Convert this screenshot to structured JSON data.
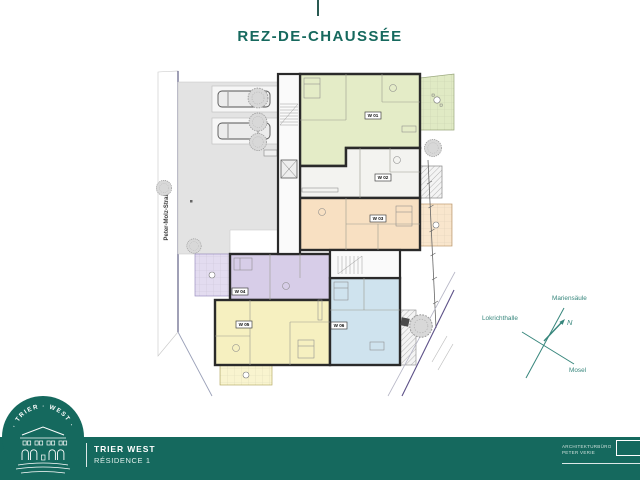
{
  "page": {
    "title": "REZ-DE-CHAUSSÉE"
  },
  "plan": {
    "street_label": "Peter-Molz-Straße",
    "units": [
      {
        "id": "W 01",
        "color": "#e4ecc7"
      },
      {
        "id": "W 02",
        "color": "#f3f3f0"
      },
      {
        "id": "W 03",
        "color": "#f8e0c2"
      },
      {
        "id": "W 04",
        "color": "#d7cde8"
      },
      {
        "id": "W 05",
        "color": "#f6f0c0"
      },
      {
        "id": "W 06",
        "color": "#cfe3ee"
      }
    ]
  },
  "compass": {
    "north": "N",
    "landmarks": [
      {
        "label": "Mariensäule"
      },
      {
        "label": "Lokrichthalle"
      },
      {
        "label": "Mosel"
      }
    ]
  },
  "footer": {
    "logo_arc": "· TRIER · WEST ·",
    "project_name": "TRIER WEST",
    "project_subtitle": "RÉSIDENCE 1",
    "credit_line1": "ARCHITEKTURBÜRO",
    "credit_line2": "PETER VERIE"
  },
  "colors": {
    "accent": "#16695e",
    "band": "#15695e",
    "compassLine": "#37867c",
    "boundary": "#5d5188"
  }
}
